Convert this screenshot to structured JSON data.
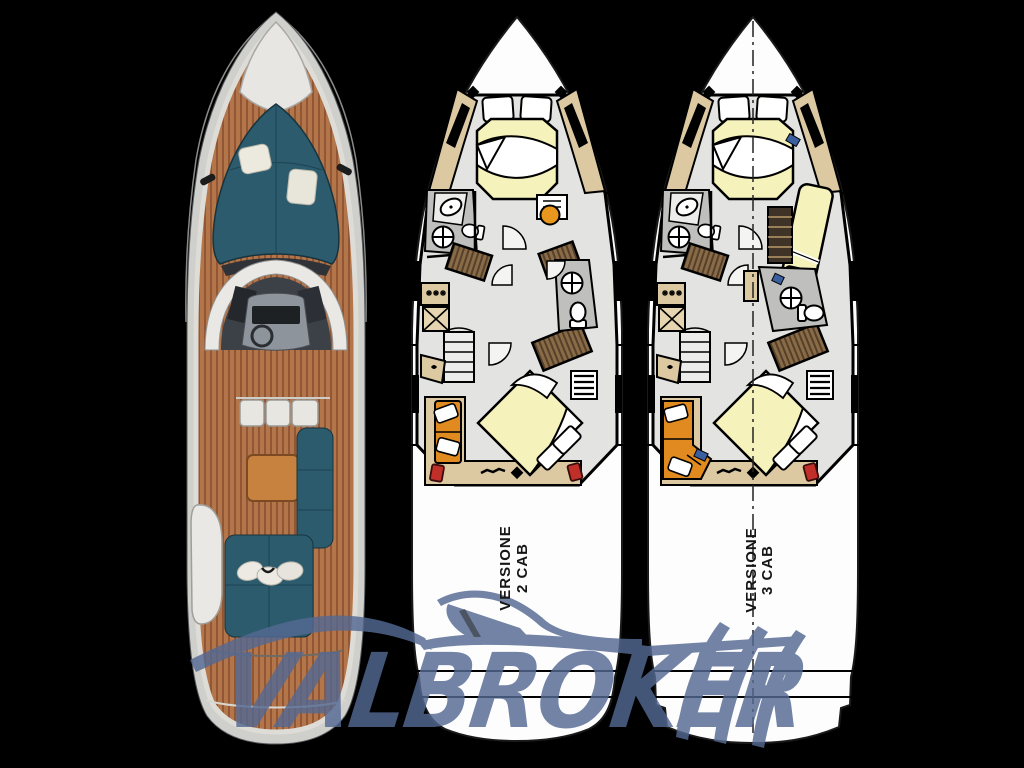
{
  "background": "#000000",
  "watermark": {
    "text": "VALBROKER",
    "color": "#546993"
  },
  "plans": [
    {
      "name": "2-cabin-version",
      "label": {
        "line1": "VERSIONE",
        "line2": "2 CAB"
      }
    },
    {
      "name": "3-cabin-version",
      "label": {
        "line1": "VERSIONE",
        "line2": "3 CAB"
      }
    }
  ],
  "colors": {
    "hull_white": "#fdfdfd",
    "floor_gray": "#e3e3e1",
    "bath_gray": "#bfbfbd",
    "trim_tan": "#dcc9a2",
    "bed_yellow": "#f6f2bb",
    "wood_brown": "#8a6b47",
    "sofa_orange": "#e08a1f",
    "accent_red": "#c03028",
    "teak_deck": "#b3754a",
    "upholstery_teal": "#2c5b6d"
  }
}
